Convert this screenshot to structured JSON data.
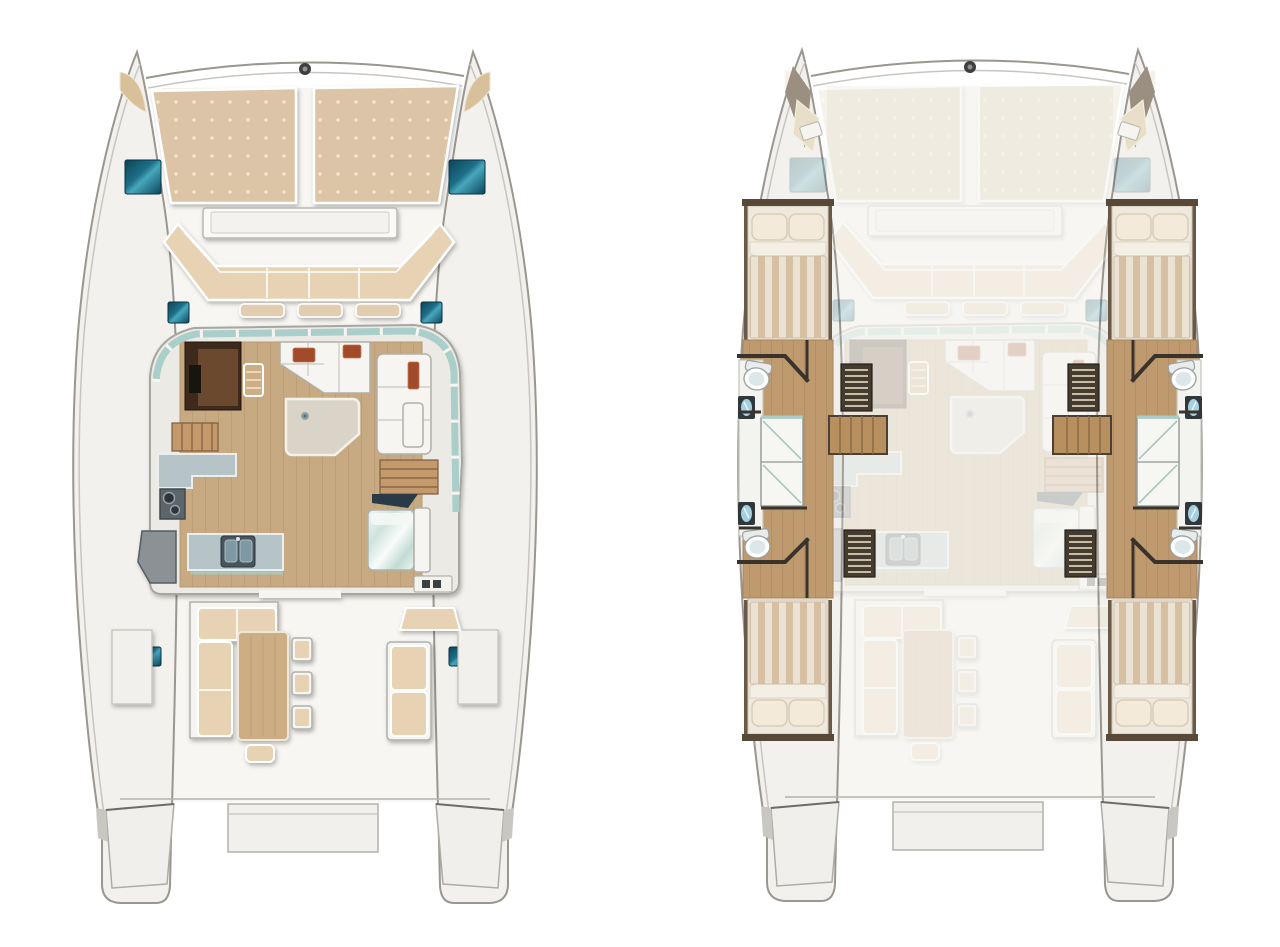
{
  "meta": {
    "kind": "catamaran-floor-plan",
    "views": 2,
    "background_color": "#ffffff"
  },
  "plans": [
    {
      "id": "main-deck",
      "position": "left",
      "features": [
        "bow-sunpads",
        "bow-crossbeam",
        "deck-hatches",
        "forward-cockpit-seating",
        "saloon-windshield",
        "navigation-cabinet",
        "forward-settee",
        "chart-table",
        "side-settee",
        "galley-counters",
        "stove",
        "double-sink",
        "companionway-stairs-port",
        "companionway-stairs-starboard",
        "aft-berth",
        "vanity",
        "aft-cockpit-sofa",
        "cockpit-dining-table",
        "cockpit-chairs",
        "cockpit-stool",
        "helm-seat",
        "aft-bench",
        "aft-platform",
        "transom-steps"
      ]
    },
    {
      "id": "lower-deck",
      "position": "right",
      "ghosted_overlay": "main-deck",
      "features": [
        "bow-lockers",
        "forward-cabin-port",
        "forward-cabin-starboard",
        "aft-cabin-port",
        "aft-cabin-starboard",
        "bathrooms",
        "toilets",
        "sinks",
        "shower-compartments",
        "wardrobe-lockers",
        "hull-stairs",
        "hull-wood-floors"
      ],
      "counts": {
        "double_beds": 4,
        "toilets": 4,
        "sinks": 4,
        "shower_compartments": 4
      }
    }
  ],
  "palette": {
    "bg": "#ffffff",
    "hullLine": "#9b968f",
    "hullEdge": "#c7c5c0",
    "hullFill": "#f2f1ed",
    "deckFill": "#f7f6f2",
    "glass": "#a7cdc8",
    "cushion": "#dcc5a6",
    "cushionLt": "#e7d2b4",
    "wood": "#c7aa82",
    "woodDark": "#b3936c",
    "lowerWood": "#bf9a6f",
    "lowerWoodDark": "#a5845c",
    "counter": "#b6c3c7",
    "counterDark": "#4a555c",
    "tableTop": "#d9d4c7",
    "cockpitTable": "#cdad83",
    "accent": "#a14b2a",
    "hatchDeep": "#0b4458",
    "hatchMid": "#1e6f88",
    "hatchLight": "#47a7bd",
    "cabinet": "#3c2c1f",
    "cabinetPanel": "#6b4a2f",
    "bedBase": "#efe8dc",
    "stripeA": "#d7bfa2",
    "stripeB": "#ece2d3",
    "pillow": "#f3ead9",
    "frame": "#574838",
    "slatDark": "#453c30",
    "slatLight": "#c9baa5",
    "stairWood": "#b8905f",
    "tile": "#f6f6f3",
    "fixture": "#8f9896",
    "sinkBlue": "#a6cfe0",
    "navy": "#2c3a46"
  },
  "ghost_opacity": 0.22
}
